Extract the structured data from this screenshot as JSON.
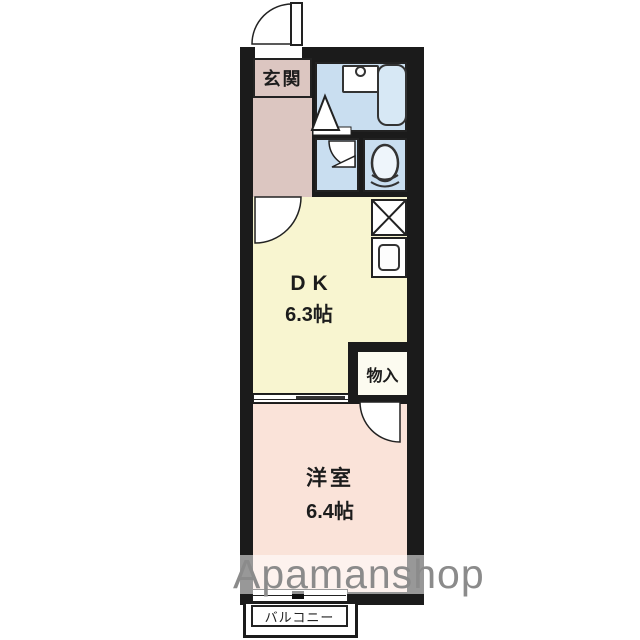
{
  "plan": {
    "rooms": {
      "entrance": {
        "label": "玄関"
      },
      "dining_kitchen": {
        "label": "DK",
        "size": "6.3帖"
      },
      "closet": {
        "label": "物入"
      },
      "western_room": {
        "label": "洋室",
        "size": "6.4帖"
      },
      "balcony": {
        "label": "バルコニー"
      }
    },
    "fixtures": [
      "entry-swing-door",
      "wash-basin",
      "bathtub",
      "bathroom-folding-door",
      "washroom-swing-door",
      "toilet",
      "washing-machine-space",
      "kitchen-sink",
      "dk-entry-swing-door",
      "closet-swing-door",
      "sliding-partition-door",
      "sliding-window"
    ],
    "colors": {
      "wall": "#1b1b1b",
      "entrance_hall": "#dcc6c1",
      "wet_area": "#c9def0",
      "dining_kitchen": "#f8f5d0",
      "western_room": "#fae3d9",
      "fixture_fill": "#ffffff"
    }
  },
  "watermark": {
    "text": "Apamanshop",
    "color": "#8b8b8b"
  }
}
